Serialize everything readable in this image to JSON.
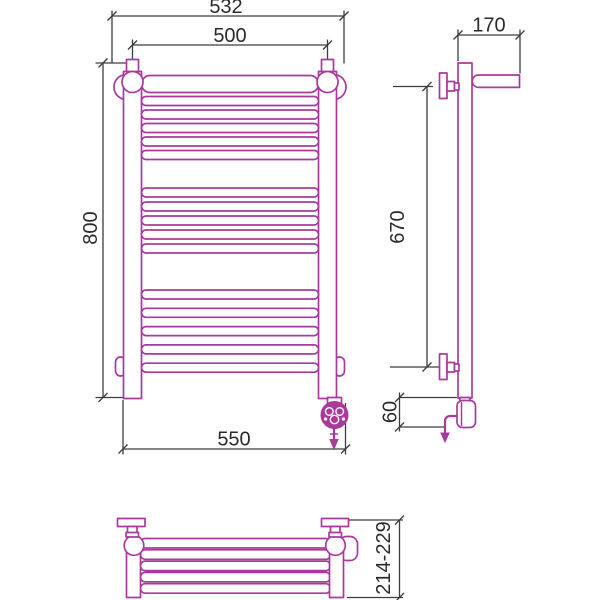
{
  "drawing": {
    "kind": "technical-dimension-drawing",
    "subject": "ladder heated towel rail with shelf and electric element (front, side and top views)",
    "colors": {
      "outline": "#a93a9c",
      "dim": "#3d3d3d",
      "text": "#2b2b2b",
      "bg": "#ffffff"
    },
    "dimensions": {
      "front_outer_width": "532",
      "front_inner_width": "500",
      "front_height": "800",
      "front_bottom_width": "550",
      "side_top_depth": "170",
      "side_bracket_span": "670",
      "side_element_height": "60",
      "top_depth_range": "214-229"
    },
    "views": {
      "front": {
        "rung_groups": [
          5,
          5,
          5
        ],
        "has_top_header_tube": true,
        "heating_element": "bottom-right with down arrow"
      },
      "side": {
        "wall_brackets": 2,
        "shelf_arm_top": true,
        "cable_arrow": "bottom-left"
      },
      "top": {
        "shelf_tubes": 5,
        "wall_brackets": 2
      }
    }
  }
}
